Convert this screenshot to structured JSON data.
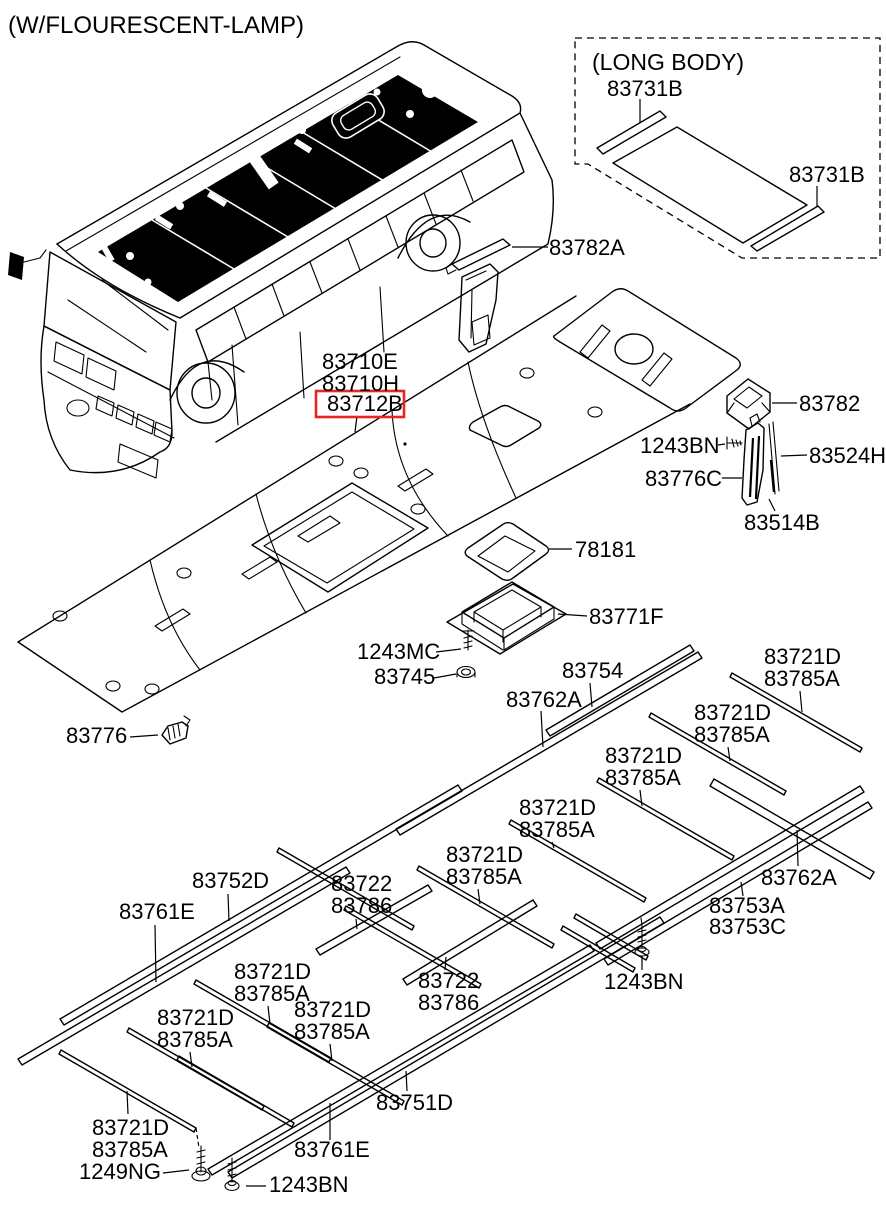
{
  "diagram": {
    "note": "(W/FLOURESCENT-LAMP)",
    "long_body_caption": "(LONG BODY)",
    "highlighted_part": "83712B",
    "colors": {
      "line": "#000000",
      "background": "#ffffff",
      "highlight_box": "#e8261f"
    },
    "parts": {
      "83731B": "83731B",
      "83782A": "83782A",
      "83710E": "83710E",
      "83710H": "83710H",
      "83712B": "83712B",
      "83782": "83782",
      "1243BN": "1243BN",
      "83524H": "83524H",
      "83776C": "83776C",
      "83514B": "83514B",
      "78181": "78181",
      "83771F": "83771F",
      "1243MC": "1243MC",
      "83745": "83745",
      "83754": "83754",
      "83762A": "83762A",
      "83721D": "83721D",
      "83785A": "83785A",
      "83776": "83776",
      "83752D": "83752D",
      "83761E": "83761E",
      "83722": "83722",
      "83786": "83786",
      "83753A": "83753A",
      "83753C": "83753C",
      "83751D": "83751D",
      "1249NG": "1249NG"
    }
  }
}
